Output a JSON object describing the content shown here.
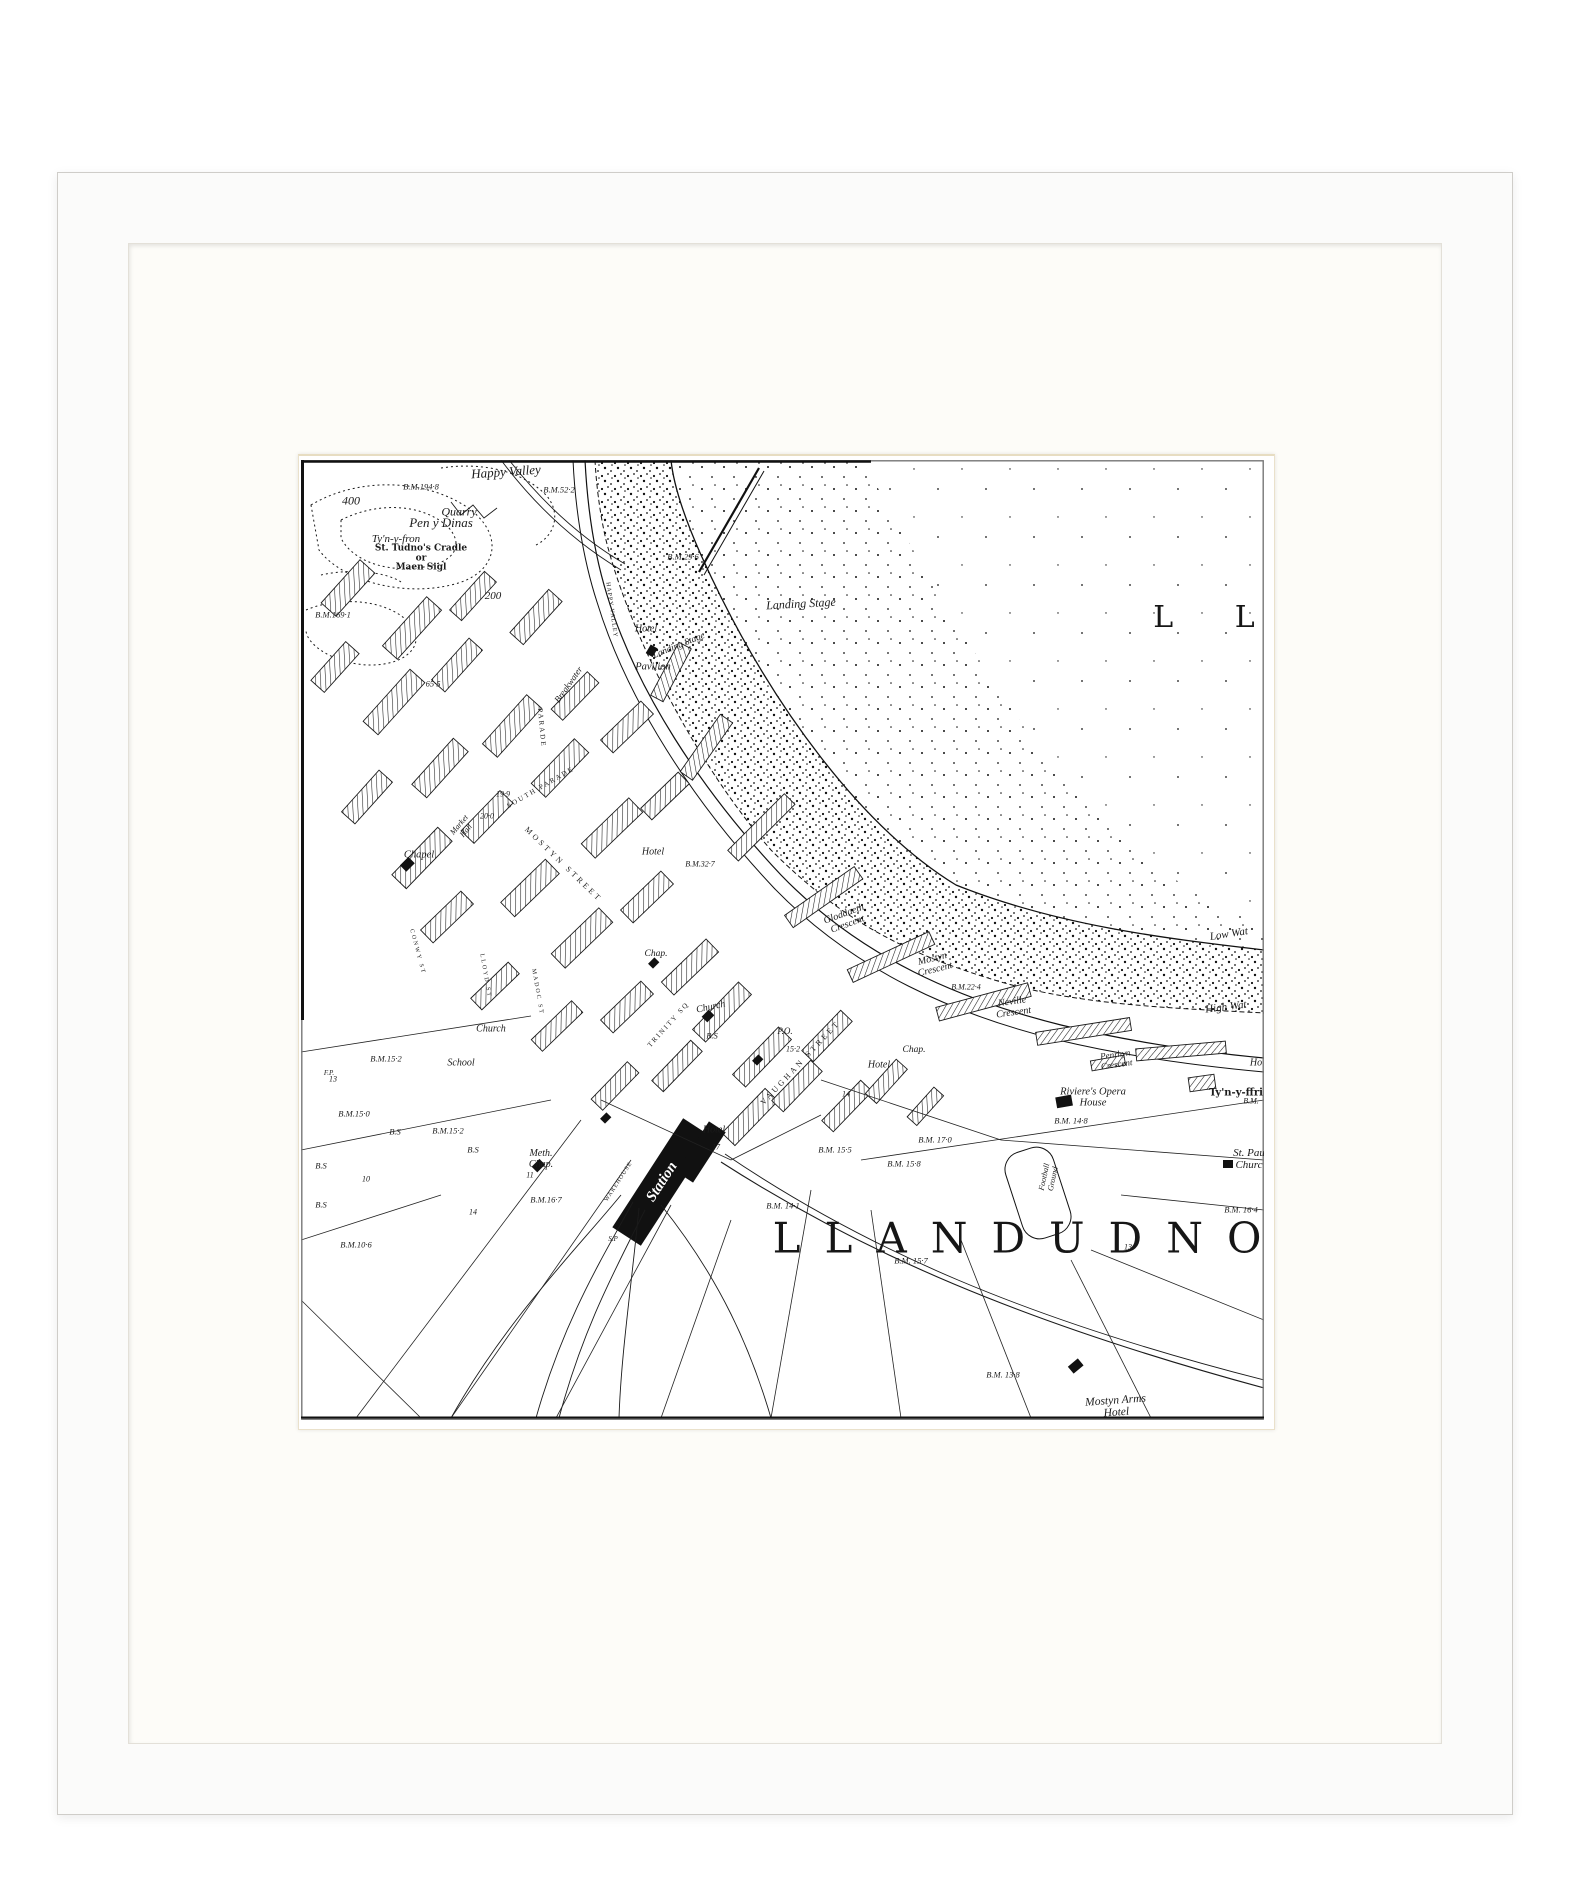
{
  "frame": {
    "frame_color": "#fbfbfa",
    "mat_color": "#fdfcf8",
    "bevel_color": "#e7ddc2",
    "paper_color": "#ffffff",
    "ink_color": "#1b1b1b"
  },
  "map": {
    "labels": [
      {
        "id": "bay-name",
        "text": "L L",
        "x": 916,
        "y": 158,
        "size": 30,
        "ls": 26,
        "cls": "big"
      },
      {
        "id": "town-name",
        "text": "LLANDUDNO",
        "x": 728,
        "y": 778,
        "size": 42,
        "ls": 24,
        "cls": "big"
      },
      {
        "id": "happy-valley",
        "text": "Happy Valley",
        "x": 205,
        "y": 12,
        "size": 13,
        "rot": -4,
        "cls": "name"
      },
      {
        "id": "bm-194-8",
        "text": "B.M.194·8",
        "x": 120,
        "y": 27,
        "size": 8.5,
        "cls": "bench"
      },
      {
        "id": "bm-52-2",
        "text": "B.M.52·2",
        "x": 258,
        "y": 30,
        "size": 8.5,
        "cls": "bench"
      },
      {
        "id": "num-400",
        "text": "400",
        "x": 50,
        "y": 41,
        "size": 12,
        "cls": "num"
      },
      {
        "id": "quarry",
        "text": "Quarry",
        "x": 158,
        "y": 52,
        "size": 12,
        "cls": "name"
      },
      {
        "id": "pen-y-dinas",
        "text": "Pen y Dinas",
        "x": 140,
        "y": 63,
        "size": 13,
        "cls": "name"
      },
      {
        "id": "tyn-y-fron",
        "text": "Ty'n-y-fron",
        "x": 95,
        "y": 80,
        "size": 11,
        "cls": "name"
      },
      {
        "id": "st-tudnos",
        "text": "St. Tudno's Cradle\nor\nMaen Sigl",
        "x": 120,
        "y": 99,
        "size": 9,
        "cls": "gothic"
      },
      {
        "id": "bm-169-1",
        "text": "B.M.169·1",
        "x": 32,
        "y": 155,
        "size": 8.5,
        "cls": "bench"
      },
      {
        "id": "bm-29-6",
        "text": "B.M.29·6",
        "x": 382,
        "y": 97,
        "size": 8.5,
        "cls": "bench"
      },
      {
        "id": "num-200",
        "text": "200",
        "x": 192,
        "y": 137,
        "size": 11,
        "cls": "num"
      },
      {
        "id": "landing-stage",
        "text": "Landing Stage",
        "x": 500,
        "y": 144,
        "size": 12,
        "rot": -3,
        "cls": "name"
      },
      {
        "id": "hotel-pier",
        "text": "Hotel",
        "x": 345,
        "y": 170,
        "size": 10,
        "cls": "name"
      },
      {
        "id": "landing-stage-2",
        "text": "Landing Stage",
        "x": 378,
        "y": 186,
        "size": 9.5,
        "rot": -22,
        "cls": "name"
      },
      {
        "id": "pavilion",
        "text": "Pavilion",
        "x": 352,
        "y": 207,
        "size": 10.5,
        "cls": "name"
      },
      {
        "id": "breakwater",
        "text": "Breakwater",
        "x": 268,
        "y": 225,
        "size": 9,
        "rot": -55,
        "cls": "name"
      },
      {
        "id": "happy-valley-rd",
        "text": "HAPPY VALLEY",
        "x": 310,
        "y": 150,
        "size": 6,
        "rot": 82,
        "ls": 1,
        "cls": "street"
      },
      {
        "id": "num-65-5",
        "text": "65·5",
        "x": 132,
        "y": 224,
        "size": 8.5,
        "cls": "num"
      },
      {
        "id": "parade-st",
        "text": "PARADE",
        "x": 240,
        "y": 268,
        "size": 7,
        "rot": 85,
        "ls": 2,
        "cls": "street"
      },
      {
        "id": "chapel-left",
        "text": "Chapel",
        "x": 118,
        "y": 395,
        "size": 10.5,
        "cls": "name"
      },
      {
        "id": "market-hall",
        "text": "Market\nHall",
        "x": 162,
        "y": 368,
        "size": 8,
        "rot": -50,
        "cls": "name"
      },
      {
        "id": "num-19-9",
        "text": "19·9",
        "x": 202,
        "y": 335,
        "size": 8,
        "cls": "num"
      },
      {
        "id": "south-parade",
        "text": "SOUTH PARADE",
        "x": 240,
        "y": 328,
        "size": 7,
        "rot": -30,
        "ls": 2,
        "cls": "street"
      },
      {
        "id": "num-20-0",
        "text": "20·0",
        "x": 186,
        "y": 357,
        "size": 8,
        "cls": "num"
      },
      {
        "id": "mostyn-street",
        "text": "MOSTYN STREET",
        "x": 262,
        "y": 405,
        "size": 8,
        "rot": 44,
        "ls": 3,
        "cls": "street"
      },
      {
        "id": "hotel-mostyn",
        "text": "Hotel",
        "x": 352,
        "y": 393,
        "size": 10,
        "cls": "name"
      },
      {
        "id": "bm-32-7",
        "text": "B.M.32·7",
        "x": 399,
        "y": 405,
        "size": 8,
        "cls": "bench"
      },
      {
        "id": "gloddaeth-cres",
        "text": "Gloddaeth\nCrescent",
        "x": 545,
        "y": 460,
        "size": 10,
        "rot": -20,
        "cls": "name"
      },
      {
        "id": "mostyn-cres",
        "text": "Mostyn\nCrescent",
        "x": 633,
        "y": 505,
        "size": 10,
        "rot": -14,
        "cls": "name"
      },
      {
        "id": "bm-22-4",
        "text": "B.M.22·4",
        "x": 665,
        "y": 528,
        "size": 8,
        "cls": "bench"
      },
      {
        "id": "neville-cres",
        "text": "Neville\nCrescent",
        "x": 712,
        "y": 548,
        "size": 10,
        "rot": -8,
        "cls": "name"
      },
      {
        "id": "low-water",
        "text": "Low Wat",
        "x": 928,
        "y": 475,
        "size": 11,
        "rot": -9,
        "cls": "name"
      },
      {
        "id": "high-water",
        "text": "High Wat",
        "x": 925,
        "y": 548,
        "size": 11,
        "rot": -7,
        "cls": "name"
      },
      {
        "id": "trinity-sq",
        "text": "TRINITY SQ",
        "x": 368,
        "y": 565,
        "size": 7,
        "rot": -48,
        "ls": 2,
        "cls": "street"
      },
      {
        "id": "church-trinity",
        "text": "Church",
        "x": 410,
        "y": 548,
        "size": 10,
        "rot": -12,
        "cls": "name"
      },
      {
        "id": "chap-trinity",
        "text": "Chap.",
        "x": 355,
        "y": 494,
        "size": 9.5,
        "cls": "name"
      },
      {
        "id": "bs-1",
        "text": "B.S",
        "x": 411,
        "y": 576,
        "size": 8.5,
        "cls": "bench"
      },
      {
        "id": "po",
        "text": "P.O.",
        "x": 484,
        "y": 572,
        "size": 9,
        "cls": "name"
      },
      {
        "id": "num-15-2",
        "text": "15·2",
        "x": 492,
        "y": 590,
        "size": 8,
        "cls": "num"
      },
      {
        "id": "vaughan-street",
        "text": "VAUGHAN STREET",
        "x": 500,
        "y": 603,
        "size": 8,
        "rot": -47,
        "ls": 3,
        "cls": "street"
      },
      {
        "id": "chap-right",
        "text": "Chap.",
        "x": 613,
        "y": 590,
        "size": 9.5,
        "cls": "name"
      },
      {
        "id": "hotel-right",
        "text": "Hotel",
        "x": 578,
        "y": 606,
        "size": 10,
        "cls": "name"
      },
      {
        "id": "num-14a",
        "text": "14",
        "x": 545,
        "y": 635,
        "size": 8,
        "cls": "num"
      },
      {
        "id": "penrhyn-cres",
        "text": "Penrhyn\nCrescent",
        "x": 815,
        "y": 600,
        "size": 9,
        "rot": -8,
        "cls": "name"
      },
      {
        "id": "opera-house",
        "text": "Riviere's Opera\nHouse",
        "x": 792,
        "y": 638,
        "size": 10.5,
        "cls": "name"
      },
      {
        "id": "tyn-y-ffrith",
        "text": "Ty'n-y-ffri",
        "x": 935,
        "y": 634,
        "size": 10,
        "cls": "gothic"
      },
      {
        "id": "ho-cut",
        "text": "Ho",
        "x": 955,
        "y": 604,
        "size": 10,
        "cls": "name"
      },
      {
        "id": "bm-cut",
        "text": "B.M.",
        "x": 950,
        "y": 642,
        "size": 8,
        "cls": "bench"
      },
      {
        "id": "bm-14-8",
        "text": "B.M. 14·8",
        "x": 770,
        "y": 661,
        "size": 8.5,
        "cls": "bench"
      },
      {
        "id": "bm-17-0",
        "text": "B.M. 17·0",
        "x": 634,
        "y": 680,
        "size": 8.5,
        "cls": "bench"
      },
      {
        "id": "bm-15-5",
        "text": "B.M. 15·5",
        "x": 534,
        "y": 690,
        "size": 8.5,
        "cls": "bench"
      },
      {
        "id": "bm-15-8",
        "text": "B.M. 15·8",
        "x": 603,
        "y": 704,
        "size": 8.5,
        "cls": "bench"
      },
      {
        "id": "st-pauls",
        "text": "St. Pau\nChurc",
        "x": 948,
        "y": 700,
        "size": 11,
        "cls": "name"
      },
      {
        "id": "football-ground",
        "text": "Football\nGround",
        "x": 748,
        "y": 718,
        "size": 8,
        "rot": -78,
        "cls": "name"
      },
      {
        "id": "church-left",
        "text": "Church",
        "x": 190,
        "y": 570,
        "size": 10,
        "cls": "name"
      },
      {
        "id": "bm-15-2a",
        "text": "B.M.15·2",
        "x": 85,
        "y": 599,
        "size": 8.5,
        "cls": "bench"
      },
      {
        "id": "school",
        "text": "School",
        "x": 160,
        "y": 604,
        "size": 10,
        "cls": "name"
      },
      {
        "id": "num-13a",
        "text": "13",
        "x": 32,
        "y": 620,
        "size": 8,
        "cls": "num"
      },
      {
        "id": "bm-15-0",
        "text": "B.M.15·0",
        "x": 53,
        "y": 654,
        "size": 8.5,
        "cls": "bench"
      },
      {
        "id": "bs-2",
        "text": "B.S",
        "x": 94,
        "y": 672,
        "size": 8.5,
        "cls": "bench"
      },
      {
        "id": "bm-15-2b",
        "text": "B.M.15·2",
        "x": 147,
        "y": 671,
        "size": 8.5,
        "cls": "bench"
      },
      {
        "id": "bs-3",
        "text": "B.S",
        "x": 172,
        "y": 690,
        "size": 8.5,
        "cls": "bench"
      },
      {
        "id": "meth-chap",
        "text": "Meth.\nChap.",
        "x": 240,
        "y": 700,
        "size": 10,
        "cls": "name"
      },
      {
        "id": "num-11",
        "text": "11",
        "x": 229,
        "y": 716,
        "size": 8,
        "cls": "num"
      },
      {
        "id": "bm-16-7",
        "text": "B.M.16·7",
        "x": 245,
        "y": 740,
        "size": 8.5,
        "cls": "bench"
      },
      {
        "id": "bs-4",
        "text": "B.S",
        "x": 20,
        "y": 706,
        "size": 8.5,
        "cls": "bench"
      },
      {
        "id": "num-10",
        "text": "10",
        "x": 65,
        "y": 720,
        "size": 8,
        "cls": "num"
      },
      {
        "id": "bs-5",
        "text": "B.S",
        "x": 20,
        "y": 745,
        "size": 8.5,
        "cls": "bench"
      },
      {
        "id": "num-14b",
        "text": "14",
        "x": 172,
        "y": 753,
        "size": 8,
        "cls": "num"
      },
      {
        "id": "bm-10-6",
        "text": "B.M.10·6",
        "x": 55,
        "y": 785,
        "size": 8.5,
        "cls": "bench"
      },
      {
        "id": "fp",
        "text": "F.P.",
        "x": 28,
        "y": 614,
        "size": 7,
        "cls": "num"
      },
      {
        "id": "sp",
        "text": "S.P",
        "x": 312,
        "y": 780,
        "size": 7,
        "cls": "num"
      },
      {
        "id": "warehouse",
        "text": "WAREHOUSE",
        "x": 318,
        "y": 722,
        "size": 6,
        "rot": -57,
        "ls": 1,
        "cls": "street"
      },
      {
        "id": "station",
        "text": "Station",
        "x": 361,
        "y": 722,
        "size": 15,
        "rot": -57,
        "cls": "white"
      },
      {
        "id": "hotel-station",
        "text": "Hotel",
        "x": 413,
        "y": 671,
        "size": 10,
        "cls": "name"
      },
      {
        "id": "num-17",
        "text": "17",
        "x": 415,
        "y": 688,
        "size": 8,
        "cls": "num"
      },
      {
        "id": "bm-14-1",
        "text": "B.M. 14·1",
        "x": 482,
        "y": 746,
        "size": 8.5,
        "cls": "bench"
      },
      {
        "id": "bm-15-7",
        "text": "B.M. 15·7",
        "x": 610,
        "y": 801,
        "size": 8.5,
        "cls": "bench"
      },
      {
        "id": "bm-16-4",
        "text": "B.M. 16·4",
        "x": 940,
        "y": 750,
        "size": 8.5,
        "cls": "bench"
      },
      {
        "id": "num-13b",
        "text": "13",
        "x": 827,
        "y": 788,
        "size": 8,
        "cls": "num"
      },
      {
        "id": "bm-13-8",
        "text": "B.M. 13·8",
        "x": 702,
        "y": 915,
        "size": 8.5,
        "cls": "bench"
      },
      {
        "id": "mostyn-arms",
        "text": "Mostyn Arms\nHotel",
        "x": 815,
        "y": 947,
        "size": 11.5,
        "rot": -4,
        "cls": "name"
      },
      {
        "id": "lloyd-st",
        "text": "LLOYD ST",
        "x": 184,
        "y": 516,
        "size": 6,
        "rot": 80,
        "ls": 2,
        "cls": "street"
      },
      {
        "id": "madoc-st",
        "text": "MADOC ST",
        "x": 236,
        "y": 532,
        "size": 6,
        "rot": 80,
        "ls": 2,
        "cls": "street"
      },
      {
        "id": "conwy-st",
        "text": "CONWY ST",
        "x": 116,
        "y": 492,
        "size": 6,
        "rot": 75,
        "ls": 2,
        "cls": "street"
      }
    ]
  }
}
